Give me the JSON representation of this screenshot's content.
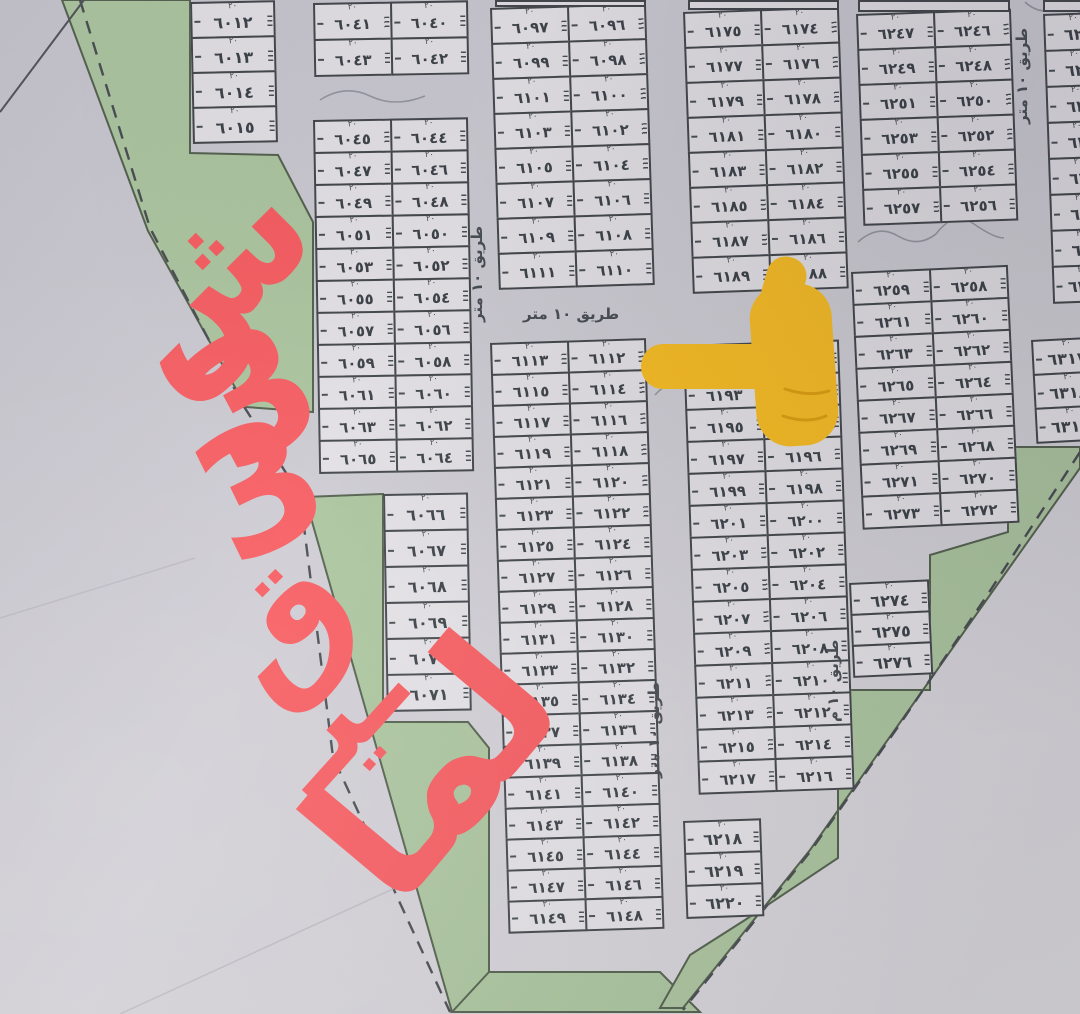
{
  "labels": {
    "road10": "طريق ١٠ متر",
    "road10_short": "طريق ١٠ م",
    "dim_top": "٢٠"
  },
  "annotation": {
    "color": "#f75f63",
    "reading": "شارع 33",
    "pieces": [
      {
        "text": "ش"
      },
      {
        "text": "3"
      },
      {
        "text": "3"
      },
      {
        "text": "ق"
      },
      {
        "text": "ـيـ"
      },
      {
        "text": "لما"
      }
    ]
  },
  "pointer": {
    "icon": "backhand-index-pointing-left",
    "color": "#f9be25",
    "shade": "#e0a011"
  },
  "map_colors": {
    "paper": "#cfcdd3",
    "plot_fill": "#e4e2e6",
    "plot_border": "#45494d",
    "green_area": "#adc6a0",
    "boundary": "#4b4f54"
  },
  "blocks": {
    "A": [
      [
        "٦٠١٢"
      ],
      [
        "٦٠١٣"
      ],
      [
        "٦٠١٤"
      ],
      [
        "٦٠١٥"
      ]
    ],
    "B": [
      [
        "٦٠٤١",
        "٦٠٤٠"
      ],
      [
        "٦٠٤٣",
        "٦٠٤٢"
      ]
    ],
    "C": [
      [
        "٦٠٤٥",
        "٦٠٤٤"
      ],
      [
        "٦٠٤٧",
        "٦٠٤٦"
      ],
      [
        "٦٠٤٩",
        "٦٠٤٨"
      ],
      [
        "٦٠٥١",
        "٦٠٥٠"
      ],
      [
        "٦٠٥٣",
        "٦٠٥٢"
      ],
      [
        "٦٠٥٥",
        "٦٠٥٤"
      ],
      [
        "٦٠٥٧",
        "٦٠٥٦"
      ],
      [
        "٦٠٥٩",
        "٦٠٥٨"
      ],
      [
        "٦٠٦١",
        "٦٠٦٠"
      ],
      [
        "٦٠٦٣",
        "٦٠٦٢"
      ],
      [
        "٦٠٦٥",
        "٦٠٦٤"
      ]
    ],
    "C2": [
      [
        "٦٠٦٦"
      ],
      [
        "٦٠٦٧"
      ],
      [
        "٦٠٦٨"
      ],
      [
        "٦٠٦٩"
      ],
      [
        "٦٠٧٠"
      ],
      [
        "٦٠٧١"
      ]
    ],
    "D": [
      [
        "٦٠٩٧",
        "٦٠٩٦"
      ],
      [
        "٦٠٩٩",
        "٦٠٩٨"
      ],
      [
        "٦١٠١",
        "٦١٠٠"
      ],
      [
        "٦١٠٣",
        "٦١٠٢"
      ],
      [
        "٦١٠٥",
        "٦١٠٤"
      ],
      [
        "٦١٠٧",
        "٦١٠٦"
      ],
      [
        "٦١٠٩",
        "٦١٠٨"
      ],
      [
        "٦١١١",
        "٦١١٠"
      ]
    ],
    "E": [
      [
        "٦١١٣",
        "٦١١٢"
      ],
      [
        "٦١١٥",
        "٦١١٤"
      ],
      [
        "٦١١٧",
        "٦١١٦"
      ],
      [
        "٦١١٩",
        "٦١١٨"
      ],
      [
        "٦١٢١",
        "٦١٢٠"
      ],
      [
        "٦١٢٣",
        "٦١٢٢"
      ],
      [
        "٦١٢٥",
        "٦١٢٤"
      ],
      [
        "٦١٢٧",
        "٦١٢٦"
      ],
      [
        "٦١٢٩",
        "٦١٢٨"
      ],
      [
        "٦١٣١",
        "٦١٣٠"
      ],
      [
        "٦١٣٣",
        "٦١٣٢"
      ],
      [
        "٦١٣٥",
        "٦١٣٤"
      ],
      [
        "٦١٣٧",
        "٦١٣٦"
      ],
      [
        "٦١٣٩",
        "٦١٣٨"
      ],
      [
        "٦١٤١",
        "٦١٤٠"
      ],
      [
        "٦١٤٣",
        "٦١٤٢"
      ],
      [
        "٦١٤٥",
        "٦١٤٤"
      ],
      [
        "٦١٤٧",
        "٦١٤٦"
      ],
      [
        "٦١٤٩",
        "٦١٤٨"
      ]
    ],
    "F": [
      [
        "٦١٧٥",
        "٦١٧٤"
      ],
      [
        "٦١٧٧",
        "٦١٧٦"
      ],
      [
        "٦١٧٩",
        "٦١٧٨"
      ],
      [
        "٦١٨١",
        "٦١٨٠"
      ],
      [
        "٦١٨٣",
        "٦١٨٢"
      ],
      [
        "٦١٨٥",
        "٦١٨٤"
      ],
      [
        "٦١٨٧",
        "٦١٨٦"
      ],
      [
        "٦١٨٩",
        "٦١٨٨"
      ]
    ],
    "G": [
      [
        "٦١٩١",
        "٦١٩٠"
      ],
      [
        "٦١٩٣",
        "٦١٩٢"
      ],
      [
        "٦١٩٥",
        "٦١٩٤"
      ],
      [
        "٦١٩٧",
        "٦١٩٦"
      ],
      [
        "٦١٩٩",
        "٦١٩٨"
      ],
      [
        "٦٢٠١",
        "٦٢٠٠"
      ],
      [
        "٦٢٠٣",
        "٦٢٠٢"
      ],
      [
        "٦٢٠٥",
        "٦٢٠٤"
      ],
      [
        "٦٢٠٧",
        "٦٢٠٦"
      ],
      [
        "٦٢٠٩",
        "٦٢٠٨"
      ],
      [
        "٦٢١١",
        "٦٢١٠"
      ],
      [
        "٦٢١٣",
        "٦٢١٢"
      ],
      [
        "٦٢١٥",
        "٦٢١٤"
      ],
      [
        "٦٢١٧",
        "٦٢١٦"
      ]
    ],
    "G2": [
      [
        "٦٢١٨"
      ],
      [
        "٦٢١٩"
      ],
      [
        "٦٢٢٠"
      ]
    ],
    "H": [
      [
        "٦٢٤٧",
        "٦٢٤٦"
      ],
      [
        "٦٢٤٩",
        "٦٢٤٨"
      ],
      [
        "٦٢٥١",
        "٦٢٥٠"
      ],
      [
        "٦٢٥٣",
        "٦٢٥٢"
      ],
      [
        "٦٢٥٥",
        "٦٢٥٤"
      ],
      [
        "٦٢٥٧",
        "٦٢٥٦"
      ]
    ],
    "I": [
      [
        "٦٢٥٩",
        "٦٢٥٨"
      ],
      [
        "٦٢٦١",
        "٦٢٦٠"
      ],
      [
        "٦٢٦٣",
        "٦٢٦٢"
      ],
      [
        "٦٢٦٥",
        "٦٢٦٤"
      ],
      [
        "٦٢٦٧",
        "٦٢٦٦"
      ],
      [
        "٦٢٦٩",
        "٦٢٦٨"
      ],
      [
        "٦٢٧١",
        "٦٢٧٠"
      ],
      [
        "٦٢٧٣",
        "٦٢٧٢"
      ]
    ],
    "I2": [
      [
        "٦٢٧٤"
      ],
      [
        "٦٢٧٥"
      ],
      [
        "٦٢٧٦"
      ]
    ],
    "J": [
      [
        "٦٢"
      ],
      [
        "٦٢"
      ],
      [
        "٦٣"
      ],
      [
        "٦٣"
      ],
      [
        "٦٣"
      ],
      [
        "٦٣"
      ],
      [
        "٦٣"
      ],
      [
        "٦٣١"
      ]
    ],
    "K": [
      [
        "٦٣١٧"
      ],
      [
        "٦٣١٨"
      ],
      [
        "٦٣١٩"
      ]
    ]
  }
}
